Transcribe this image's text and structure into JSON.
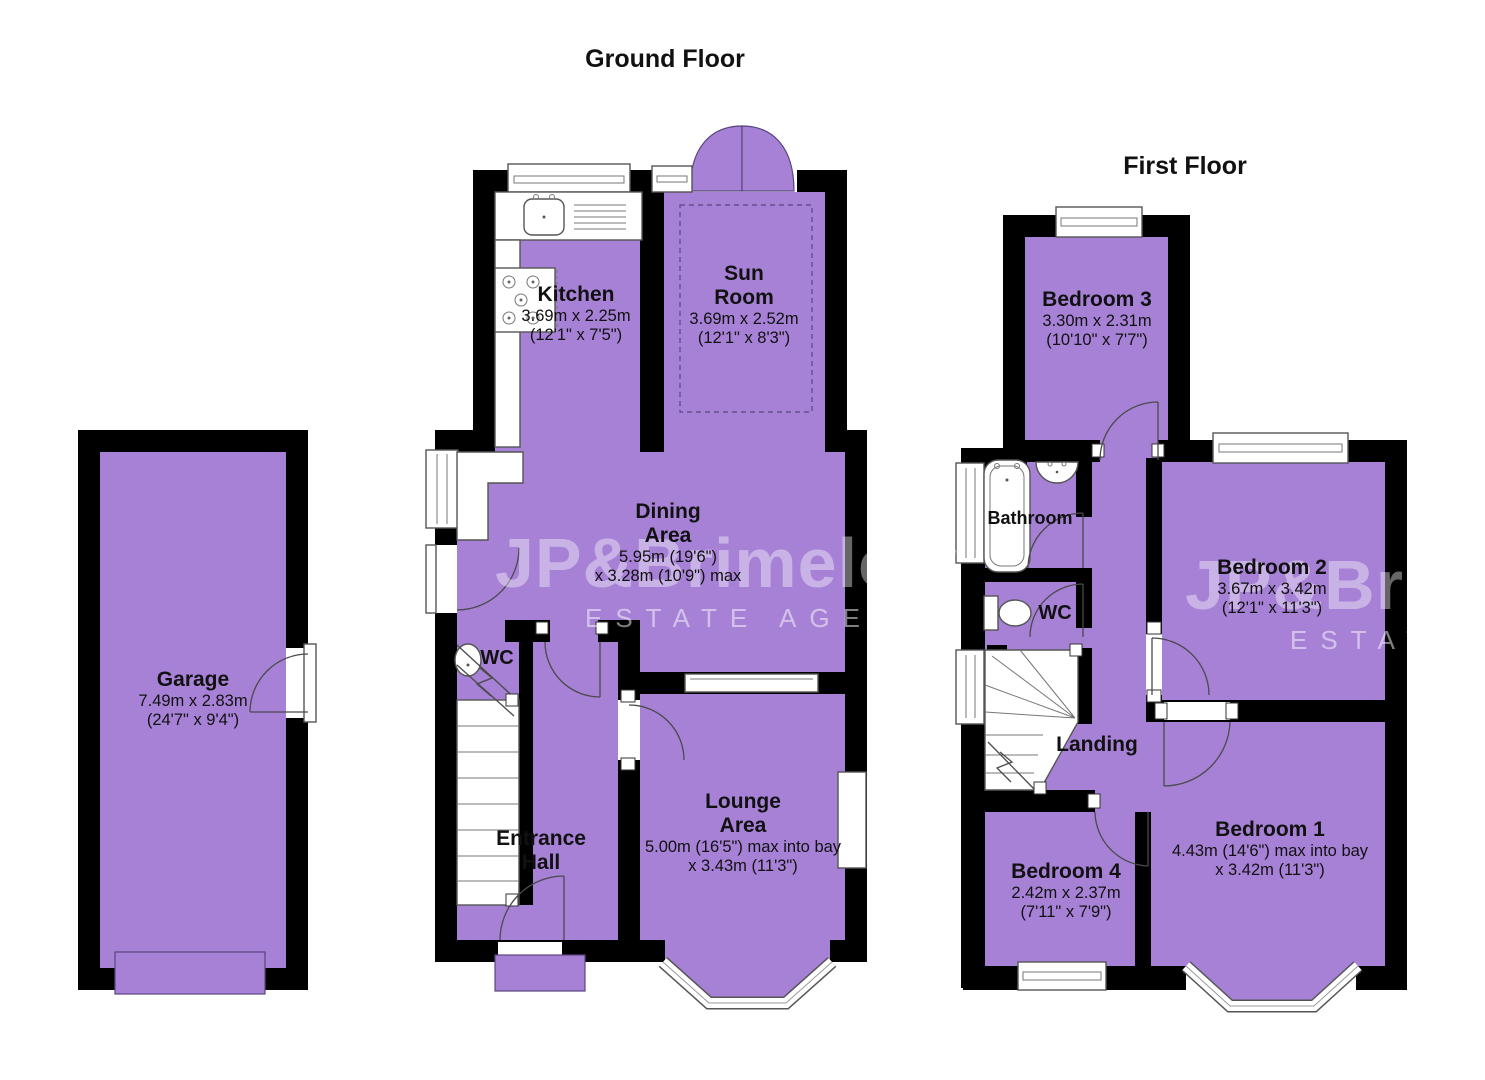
{
  "colors": {
    "room_fill": "#a681d6",
    "wall": "#000000",
    "watermark": "rgba(255,255,255,0.40)",
    "watermark_strong": "rgba(255,255,255,0.50)"
  },
  "titles": {
    "ground_floor": "Ground Floor",
    "first_floor": "First Floor"
  },
  "watermark": {
    "line1": "JP&Brimelow",
    "line2": "ESTATE AGENTS"
  },
  "ground_floor": {
    "garage": {
      "name": "Garage",
      "dim_metric": "7.49m x 2.83m",
      "dim_imperial": "(24'7\" x 9'4\")"
    },
    "kitchen": {
      "name": "Kitchen",
      "dim_metric": "3.69m x 2.25m",
      "dim_imperial": "(12'1\" x 7'5\")"
    },
    "sun_room": {
      "name_line1": "Sun",
      "name_line2": "Room",
      "dim_metric": "3.69m x 2.52m",
      "dim_imperial": "(12'1\" x 8'3\")"
    },
    "dining_area": {
      "name_line1": "Dining",
      "name_line2": "Area",
      "dim_metric": "5.95m (19'6\")",
      "dim_imperial": "x 3.28m (10'9\") max"
    },
    "wc": {
      "name": "WC"
    },
    "entrance_hall": {
      "name_line1": "Entrance",
      "name_line2": "Hall"
    },
    "lounge_area": {
      "name_line1": "Lounge",
      "name_line2": "Area",
      "dim_metric": "5.00m (16'5\") max into bay",
      "dim_imperial": "x 3.43m (11'3\")"
    }
  },
  "first_floor": {
    "bedroom_3": {
      "name": "Bedroom 3",
      "dim_metric": "3.30m x 2.31m",
      "dim_imperial": "(10'10\" x 7'7\")"
    },
    "bathroom": {
      "name": "Bathroom"
    },
    "wc": {
      "name": "WC"
    },
    "landing": {
      "name": "Landing"
    },
    "bedroom_2": {
      "name": "Bedroom 2",
      "dim_metric": "3.67m x 3.42m",
      "dim_imperial": "(12'1\" x 11'3\")"
    },
    "bedroom_4": {
      "name": "Bedroom 4",
      "dim_metric": "2.42m x 2.37m",
      "dim_imperial": "(7'11\" x 7'9\")"
    },
    "bedroom_1": {
      "name": "Bedroom 1",
      "dim_metric": "4.43m (14'6\") max into bay",
      "dim_imperial": "x 3.42m (11'3\")"
    }
  }
}
